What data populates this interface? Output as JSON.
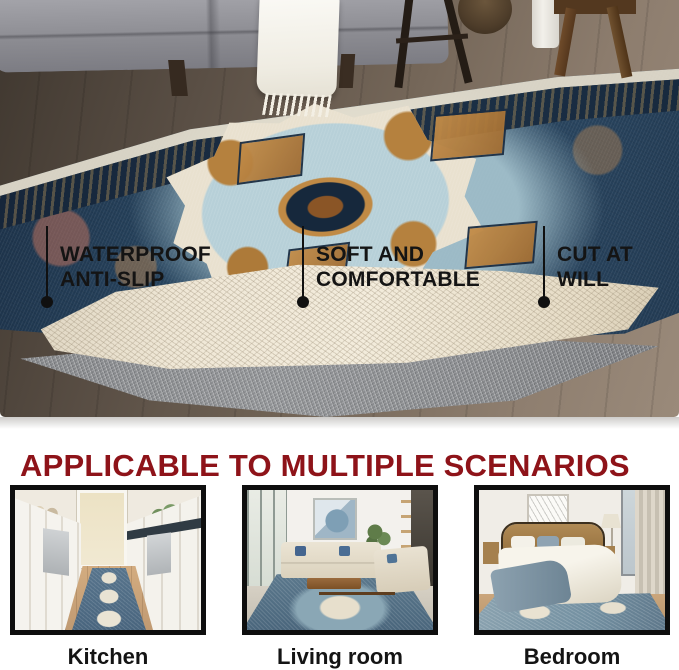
{
  "hero": {
    "alt": "Persian-style medallion rug with a corner folded back to reveal the anti-slip underside and a gray felt rug pad, in a living room with a gray sofa on a wood floor",
    "callouts": [
      {
        "line1": "WATERPROOF",
        "line2": "ANTI-SLIP"
      },
      {
        "line1": "SOFT AND",
        "line2": "COMFORTABLE"
      },
      {
        "line1": "CUT AT",
        "line2": "WILL"
      }
    ],
    "colors": {
      "callout_text": "#141414",
      "rug_navy": "#22384e",
      "rug_light_blue": "#a6c4cf",
      "rug_cream": "#ece4d2",
      "rug_rust": "#b5823f",
      "pad_gray": "#87898c",
      "underside_cream": "#ece3d1"
    }
  },
  "section": {
    "heading": "APPLICABLE TO MULTIPLE SCENARIOS",
    "heading_color": "#8e1319",
    "scenarios": [
      {
        "label": "Kitchen",
        "alt": "Galley kitchen with white cabinets and a blue runner rug on a wood floor"
      },
      {
        "label": "Living room",
        "alt": "Living room with beige sofas, blue pillows, wall art and the blue medallion rug"
      },
      {
        "label": "Bedroom",
        "alt": "Bedroom with wooden bed, white and blue bedding, and the blue rug underneath"
      }
    ]
  }
}
